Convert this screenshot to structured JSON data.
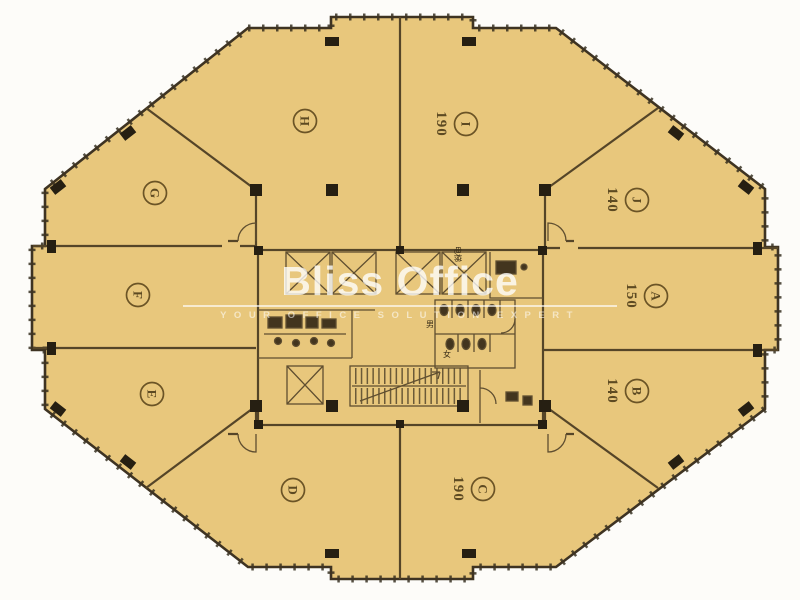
{
  "brand": {
    "name": "Bliss Office",
    "tagline": "YOUR OFFICE SOLUTION EXPERT"
  },
  "units": [
    {
      "letter": "A",
      "area": "150"
    },
    {
      "letter": "B",
      "area": "140"
    },
    {
      "letter": "C",
      "area": "190"
    },
    {
      "letter": "D",
      "area": ""
    },
    {
      "letter": "E",
      "area": ""
    },
    {
      "letter": "F",
      "area": ""
    },
    {
      "letter": "G",
      "area": ""
    },
    {
      "letter": "H",
      "area": ""
    },
    {
      "letter": "I",
      "area": "190"
    },
    {
      "letter": "J",
      "area": "140"
    }
  ],
  "core": {
    "elevator_label": "电梯",
    "male_label": "男",
    "female_label": "女"
  },
  "colors": {
    "floor": "#e8c77c",
    "wall": "#3e3322",
    "column": "#261f12",
    "label": "#5d4a22",
    "watermark": "#ffffff"
  }
}
